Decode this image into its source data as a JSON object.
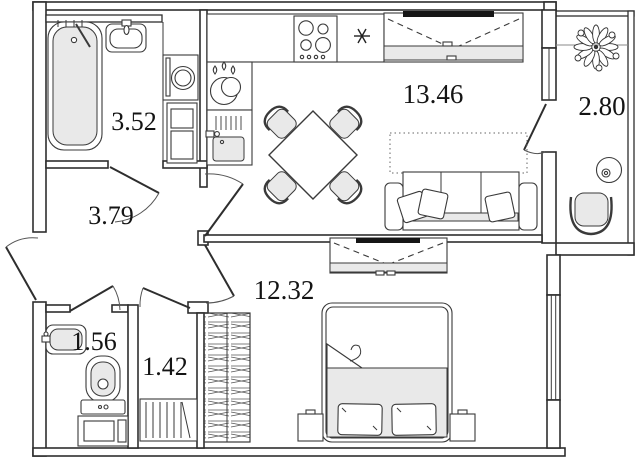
{
  "rooms": [
    {
      "id": "bathroom",
      "area": "3.52"
    },
    {
      "id": "hallway",
      "area": "3.79"
    },
    {
      "id": "kitchen-living-room",
      "area": "13.46"
    },
    {
      "id": "balcony",
      "area": "2.80"
    },
    {
      "id": "toilet",
      "area": "1.56"
    },
    {
      "id": "closet",
      "area": "1.42"
    },
    {
      "id": "bedroom",
      "area": "12.32"
    }
  ],
  "colors": {
    "walls": "#2e2e2e",
    "furniture_outline": "#3a3a3a",
    "light_fill": "#e9e9e9",
    "background": "#ffffff",
    "label_text": "#141414"
  }
}
